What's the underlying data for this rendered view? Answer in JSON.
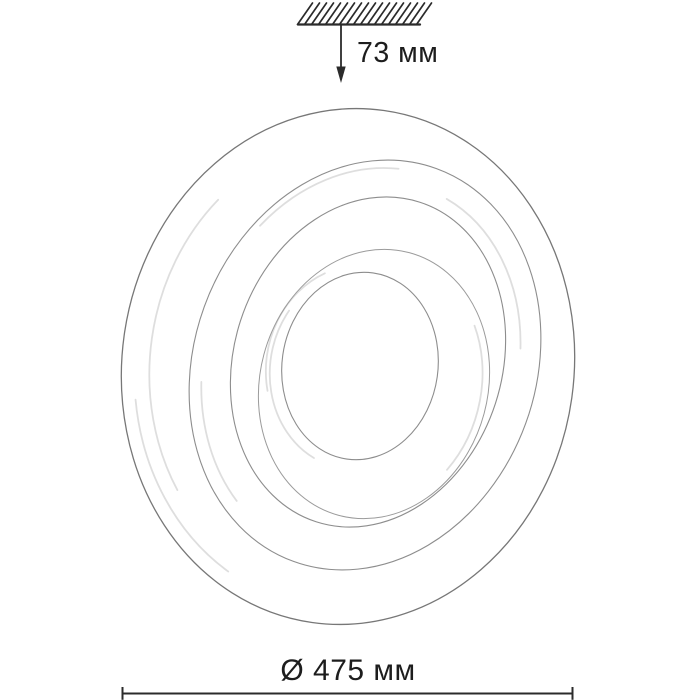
{
  "dimensions": {
    "height_label": "73 мм",
    "diameter_label": "Ø 475 мм"
  },
  "colors": {
    "dimension_lines": "#2b2b2b",
    "text": "#1d1d1d",
    "rings": "#8d8d8d",
    "rings_outer": "#777777",
    "rings_faint": "#d9d9d9",
    "background": "#ffffff"
  }
}
